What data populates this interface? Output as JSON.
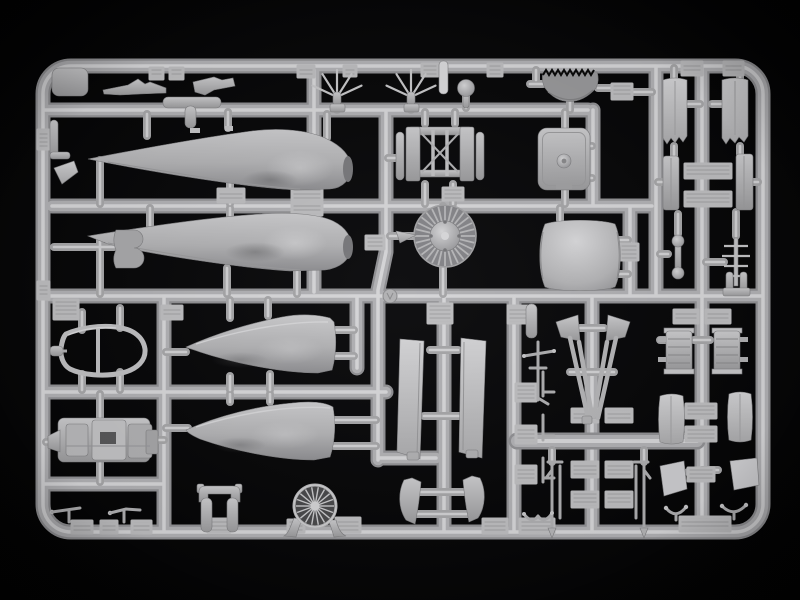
{
  "scene": {
    "title": "Plastic model kit sprue",
    "aria_label": "Photograph of a light-gray injection-molded plastic sprue from an aircraft model kit on a black background. A rectangular runner frame holds fuselage halves, an engine cowling, a radial engine, a canopy frame, a cockpit tub, landing-gear struts, gear doors and many small parts connected by thin gates.",
    "subject": "injection-molded polystyrene sprue with aircraft model parts",
    "background": "black",
    "plastic_color": "light gray"
  },
  "palette": {
    "background": "#050505",
    "runner-dark": "#919194",
    "runner": "#b1b1b4",
    "runner-hi": "#d5d5d7",
    "gate": "#a6a6a8",
    "gate-hi": "#d0d0d2",
    "part-light": "#cacacc",
    "part-mid": "#a9a9ab",
    "part-dark": "#8e8e90",
    "tab": "#bdbdbf"
  },
  "parts": [
    {
      "name": "runner-frame",
      "bbox": [
        35,
        58,
        736,
        482
      ]
    },
    {
      "name": "front-fuselage-half-upper",
      "bbox": [
        87,
        127,
        265,
        64
      ]
    },
    {
      "name": "front-fuselage-half-lower",
      "bbox": [
        87,
        212,
        265,
        62
      ]
    },
    {
      "name": "rear-fuselage-half-upper",
      "bbox": [
        185,
        313,
        152,
        61
      ]
    },
    {
      "name": "rear-fuselage-half-lower",
      "bbox": [
        185,
        401,
        151,
        60
      ]
    },
    {
      "name": "engine-cowling",
      "bbox": [
        538,
        219,
        84,
        72
      ]
    },
    {
      "name": "cowl-flap-ring",
      "bbox": [
        541,
        68,
        58,
        40
      ]
    },
    {
      "name": "radial-engine",
      "bbox": [
        414,
        205,
        62,
        62
      ]
    },
    {
      "name": "engine-mount-frame",
      "bbox": [
        396,
        125,
        90,
        57
      ]
    },
    {
      "name": "firewall-bulkhead",
      "bbox": [
        538,
        127,
        52,
        64
      ]
    },
    {
      "name": "cockpit-canopy-frame",
      "bbox": [
        50,
        325,
        96,
        50
      ]
    },
    {
      "name": "cockpit-tub",
      "bbox": [
        48,
        410,
        112,
        58
      ]
    },
    {
      "name": "cowling-front-fan-ring",
      "bbox": [
        293,
        484,
        44,
        53
      ]
    },
    {
      "name": "sight-spider-left",
      "bbox": [
        312,
        70,
        50,
        40
      ]
    },
    {
      "name": "sight-spider-right",
      "bbox": [
        386,
        70,
        50,
        40
      ]
    },
    {
      "name": "machine-gun-upper",
      "bbox": [
        102,
        77,
        66,
        18
      ]
    },
    {
      "name": "machine-gun-with-jacket",
      "bbox": [
        163,
        76,
        72,
        33
      ]
    },
    {
      "name": "ball-grip",
      "bbox": [
        457,
        79,
        18,
        31
      ]
    },
    {
      "name": "flat-strut-bar",
      "bbox": [
        439,
        61,
        9,
        33
      ]
    },
    {
      "name": "main-gear-strut-left",
      "bbox": [
        552,
        315,
        40,
        105
      ]
    },
    {
      "name": "main-gear-strut-right",
      "bbox": [
        598,
        315,
        40,
        105
      ]
    },
    {
      "name": "tail-strut",
      "bbox": [
        522,
        340,
        34,
        64
      ]
    },
    {
      "name": "lower-fork-left",
      "bbox": [
        544,
        460,
        20,
        78
      ]
    },
    {
      "name": "lower-fork-right",
      "bbox": [
        630,
        460,
        20,
        78
      ]
    },
    {
      "name": "gear-cover-blade-left",
      "bbox": [
        396,
        337,
        30,
        123
      ]
    },
    {
      "name": "gear-cover-blade-right",
      "bbox": [
        458,
        336,
        30,
        123
      ]
    },
    {
      "name": "curved-horn-left",
      "bbox": [
        398,
        476,
        24,
        48
      ]
    },
    {
      "name": "curved-horn-right",
      "bbox": [
        462,
        474,
        24,
        48
      ]
    },
    {
      "name": "split-flap-panel-left",
      "bbox": [
        663,
        78,
        28,
        64
      ]
    },
    {
      "name": "split-flap-panel-right",
      "bbox": [
        722,
        78,
        30,
        64
      ]
    },
    {
      "name": "panel-set-middle-right",
      "bbox": [
        663,
        152,
        90,
        62
      ]
    },
    {
      "name": "radiator-block-left",
      "bbox": [
        664,
        328,
        32,
        46
      ]
    },
    {
      "name": "radiator-block-right",
      "bbox": [
        712,
        328,
        32,
        46
      ]
    },
    {
      "name": "gear-door-left",
      "bbox": [
        658,
        393,
        27,
        50
      ]
    },
    {
      "name": "gear-door-right",
      "bbox": [
        728,
        391,
        25,
        50
      ]
    },
    {
      "name": "flat-door-left",
      "bbox": [
        660,
        461,
        27,
        35
      ]
    },
    {
      "name": "flat-door-right",
      "bbox": [
        730,
        458,
        29,
        32
      ]
    },
    {
      "name": "wishbone-left",
      "bbox": [
        664,
        503,
        24,
        19
      ]
    },
    {
      "name": "wishbone-right",
      "bbox": [
        720,
        501,
        28,
        19
      ]
    },
    {
      "name": "pushrod-dumbbell",
      "bbox": [
        670,
        234,
        16,
        46
      ]
    },
    {
      "name": "antenna-ladder",
      "bbox": [
        720,
        238,
        32,
        48
      ]
    },
    {
      "name": "two-prong-bracket",
      "bbox": [
        723,
        270,
        28,
        26
      ]
    },
    {
      "name": "fork-clamp",
      "bbox": [
        197,
        484,
        46,
        48
      ]
    },
    {
      "name": "pitot-probe-left",
      "bbox": [
        48,
        506,
        34,
        17
      ]
    },
    {
      "name": "pitot-probe-right",
      "bbox": [
        108,
        507,
        34,
        16
      ]
    },
    {
      "name": "side-clip",
      "bbox": [
        114,
        228,
        40,
        40
      ]
    },
    {
      "name": "winglet-blade",
      "bbox": [
        52,
        160,
        28,
        26
      ]
    },
    {
      "name": "cylinder-bracket",
      "bbox": [
        48,
        118,
        24,
        42
      ]
    },
    {
      "name": "pointed-tip",
      "bbox": [
        395,
        229,
        22,
        15
      ]
    }
  ]
}
